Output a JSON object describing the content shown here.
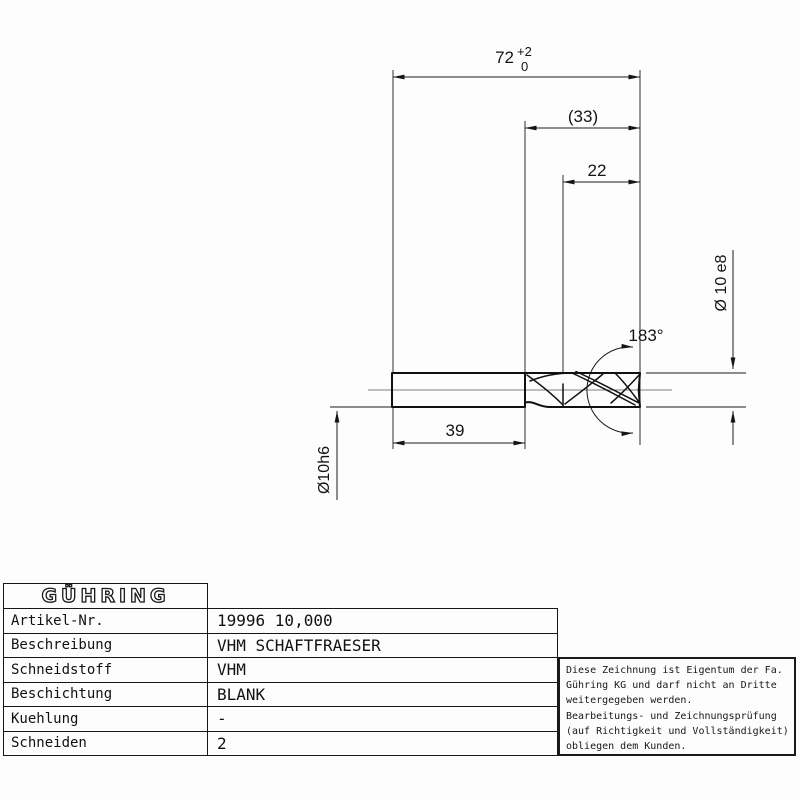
{
  "drawing": {
    "dimensions": {
      "overall_length": "72",
      "overall_length_tol_upper": "+2",
      "overall_length_tol_lower": "0",
      "length_to_shank": "(33)",
      "cutting_length": "22",
      "shank_length": "39",
      "point_angle": "183°",
      "cutting_diameter": "Ø 10 e8",
      "shank_diameter": "Ø10h6"
    }
  },
  "title_block": {
    "logo_text": "GÜHRING",
    "rows": [
      {
        "label": "Artikel-Nr.",
        "value": "19996 10,000"
      },
      {
        "label": "Beschreibung",
        "value": "VHM SCHAFTFRAESER"
      },
      {
        "label": "Schneidstoff",
        "value": "VHM"
      },
      {
        "label": "Beschichtung",
        "value": "BLANK"
      },
      {
        "label": "Kuehlung",
        "value": "-"
      },
      {
        "label": "Schneiden",
        "value": "2"
      }
    ]
  },
  "disclaimer": {
    "lines": [
      "Diese Zeichnung ist Eigentum der Fa.",
      "Gühring KG und darf nicht an Dritte",
      "weitergegeben werden.",
      "Bearbeitungs- und Zeichnungsprüfung",
      "(auf Richtigkeit und Vollständigkeit)",
      "obliegen dem Kunden."
    ]
  },
  "colors": {
    "line": "#1a1a1a",
    "background": "#fdfdfd"
  }
}
